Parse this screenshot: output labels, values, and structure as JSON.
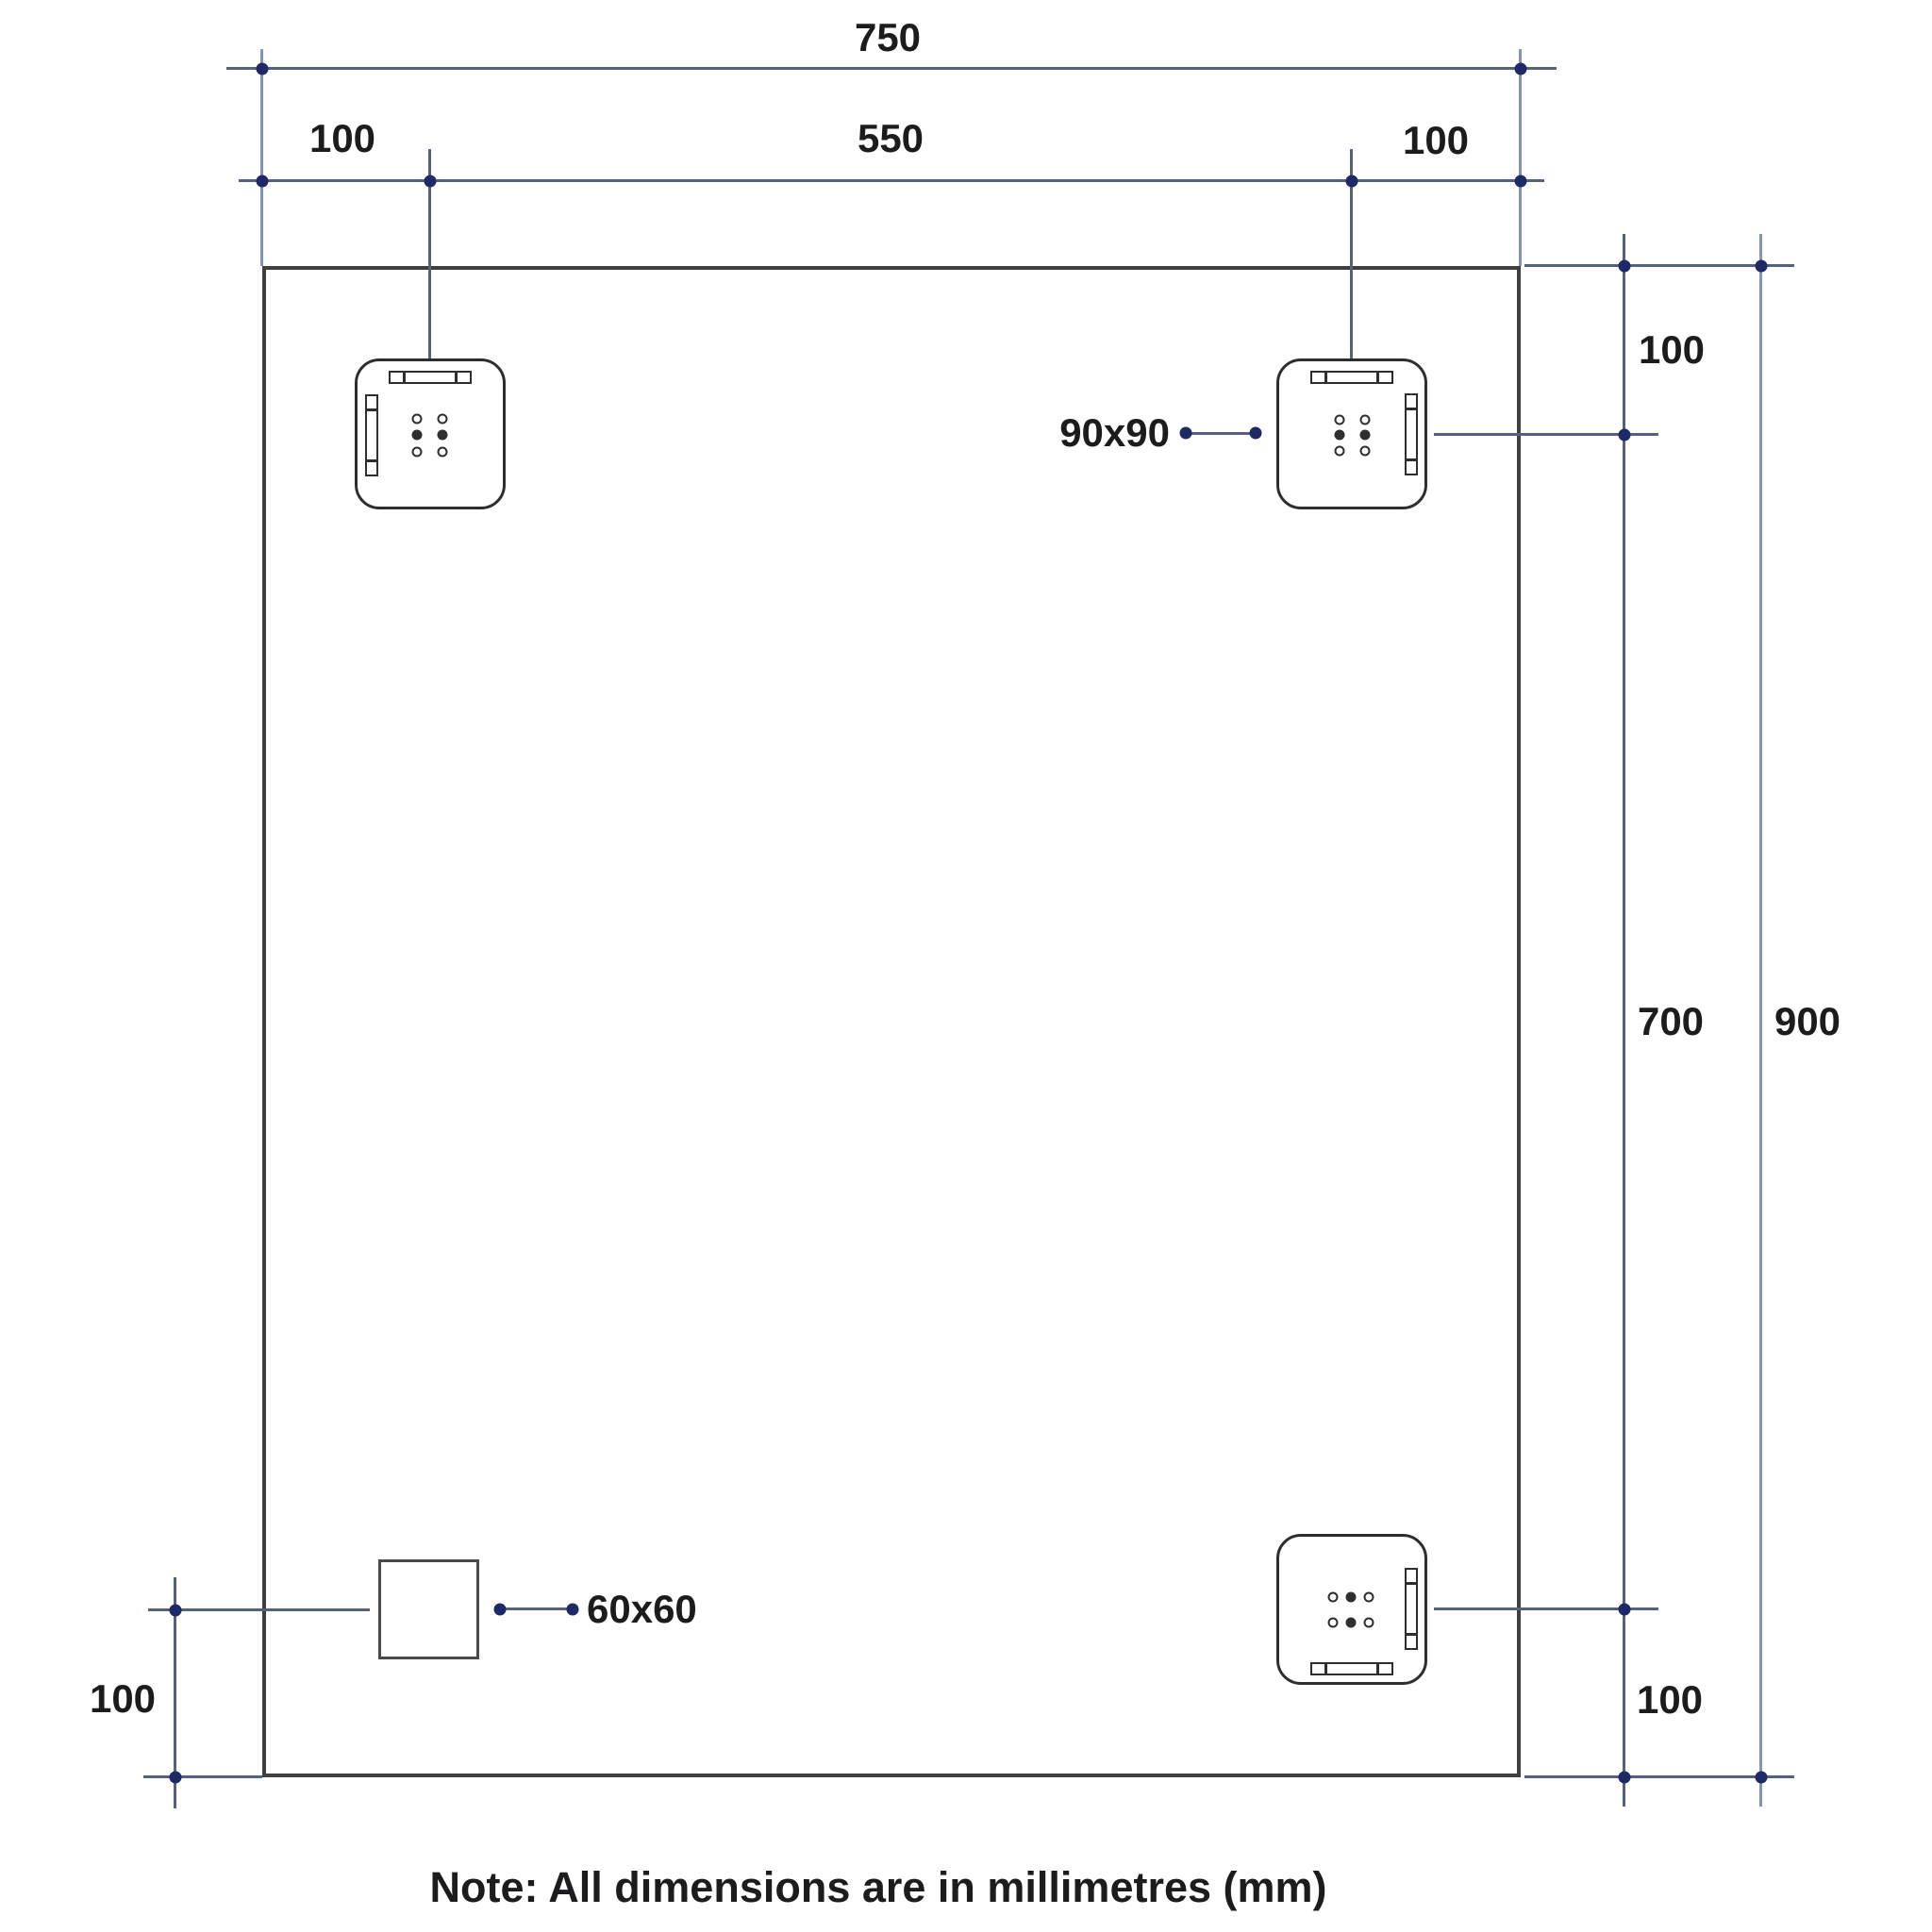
{
  "title": "Mirror mounting dimensions drawing",
  "dims": {
    "width_overall": "750",
    "width_left": "100",
    "width_center": "550",
    "width_right": "100",
    "height_top": "100",
    "height_middle": "700",
    "height_overall": "900",
    "height_bottom": "100",
    "left_bottom": "100"
  },
  "callouts": {
    "bracket_size": "90x90",
    "square_size": "60x60"
  },
  "note": "Note: All dimensions are in millimetres (mm)",
  "colors": {
    "background": "#ffffff",
    "panel_outline": "#3f3f3f",
    "bracket_outline": "#2e2e2e",
    "dimension_line": "#55627e",
    "extension_line": "#8494b6",
    "dimension_dot": "#1d2a66",
    "text": "#1c1c1e"
  }
}
